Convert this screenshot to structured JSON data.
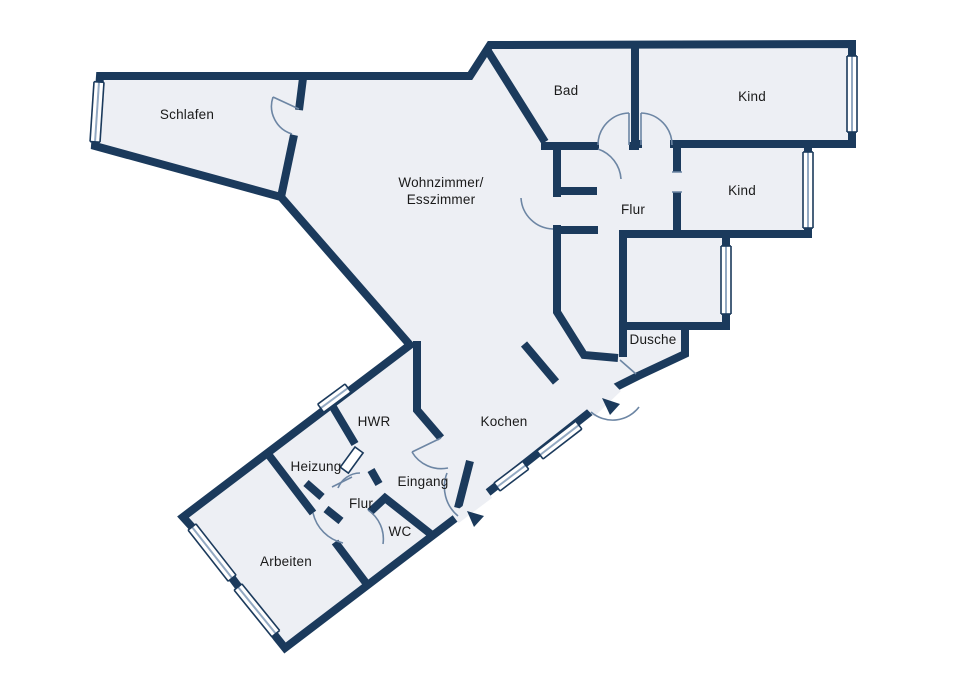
{
  "colors": {
    "background": "#ffffff",
    "wall": "#1b3a5c",
    "floor": "#edeff4",
    "door_arc": "#6d86a4",
    "window_center_line": "#93a9c2",
    "label_text": "#1a1a1a"
  },
  "rooms": {
    "schlafen": {
      "label": "Schlafen"
    },
    "wohnzimmer": {
      "label_line1": "Wohnzimmer/",
      "label_line2": "Esszimmer"
    },
    "bad": {
      "label": "Bad"
    },
    "kind_oben": {
      "label": "Kind"
    },
    "kind_rechts": {
      "label": "Kind"
    },
    "flur_oben": {
      "label": "Flur"
    },
    "dusche": {
      "label": "Dusche"
    },
    "kochen": {
      "label": "Kochen"
    },
    "hwr": {
      "label": "HWR"
    },
    "heizung": {
      "label": "Heizung"
    },
    "eingang": {
      "label": "Eingang"
    },
    "flur_unten": {
      "label": "Flur"
    },
    "wc": {
      "label": "WC"
    },
    "arbeiten": {
      "label": "Arbeiten"
    }
  }
}
